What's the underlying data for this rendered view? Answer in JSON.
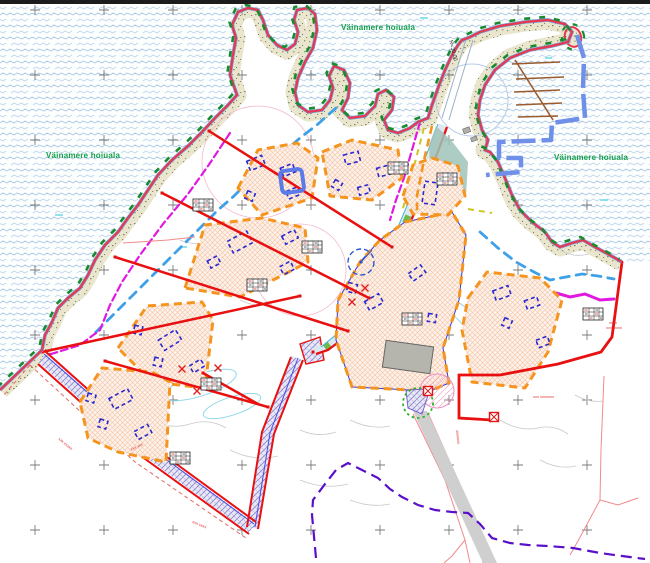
{
  "map": {
    "type": "detail-plan-site-map",
    "labels": {
      "protected_area": [
        {
          "id": "left",
          "text": "Väinamere hoiuala"
        },
        {
          "id": "top",
          "text": "Väinamere hoiuala"
        },
        {
          "id": "right",
          "text": "Väinamere hoiuala"
        }
      ],
      "road_radius": "R=30.00",
      "tiny": [
        {
          "id": "ne-boundary-line1",
          "text": "xxxx"
        },
        {
          "id": "ne-boundary-line2",
          "text": "xxxxxxxx"
        },
        {
          "id": "sw-corridor",
          "text": "xxx xxxx"
        },
        {
          "id": "south-road",
          "text": "xxxxxxx"
        },
        {
          "id": "se-parcel",
          "text": "xxx xxxxxxx"
        },
        {
          "id": "west-corridor",
          "text": "xxx xxxxx"
        },
        {
          "id": "sw-zone",
          "text": "xxx xxx"
        }
      ]
    },
    "colors": {
      "sea_wave": "#a9c6e4",
      "shoreline_red": "#e8384f",
      "coastal_band": "#e9e6cd",
      "protected_green": "#12a04b",
      "shore_dash_green": "#188c2c",
      "boundary_red": "#e81010",
      "zone_orange": "#f5941e",
      "zone_fill": "#fdf2ea",
      "building_blue": "#2a2ad0",
      "stream_blue": "#3da0e8",
      "magenta_line": "#e018e0",
      "harbor_blue": "#6f8fe8",
      "pier_brown": "#9a5b2d",
      "purple_dash": "#5a0fc8",
      "road_gray": "#cfcfcf",
      "existing_building_gray": "#b5b5ad"
    }
  }
}
